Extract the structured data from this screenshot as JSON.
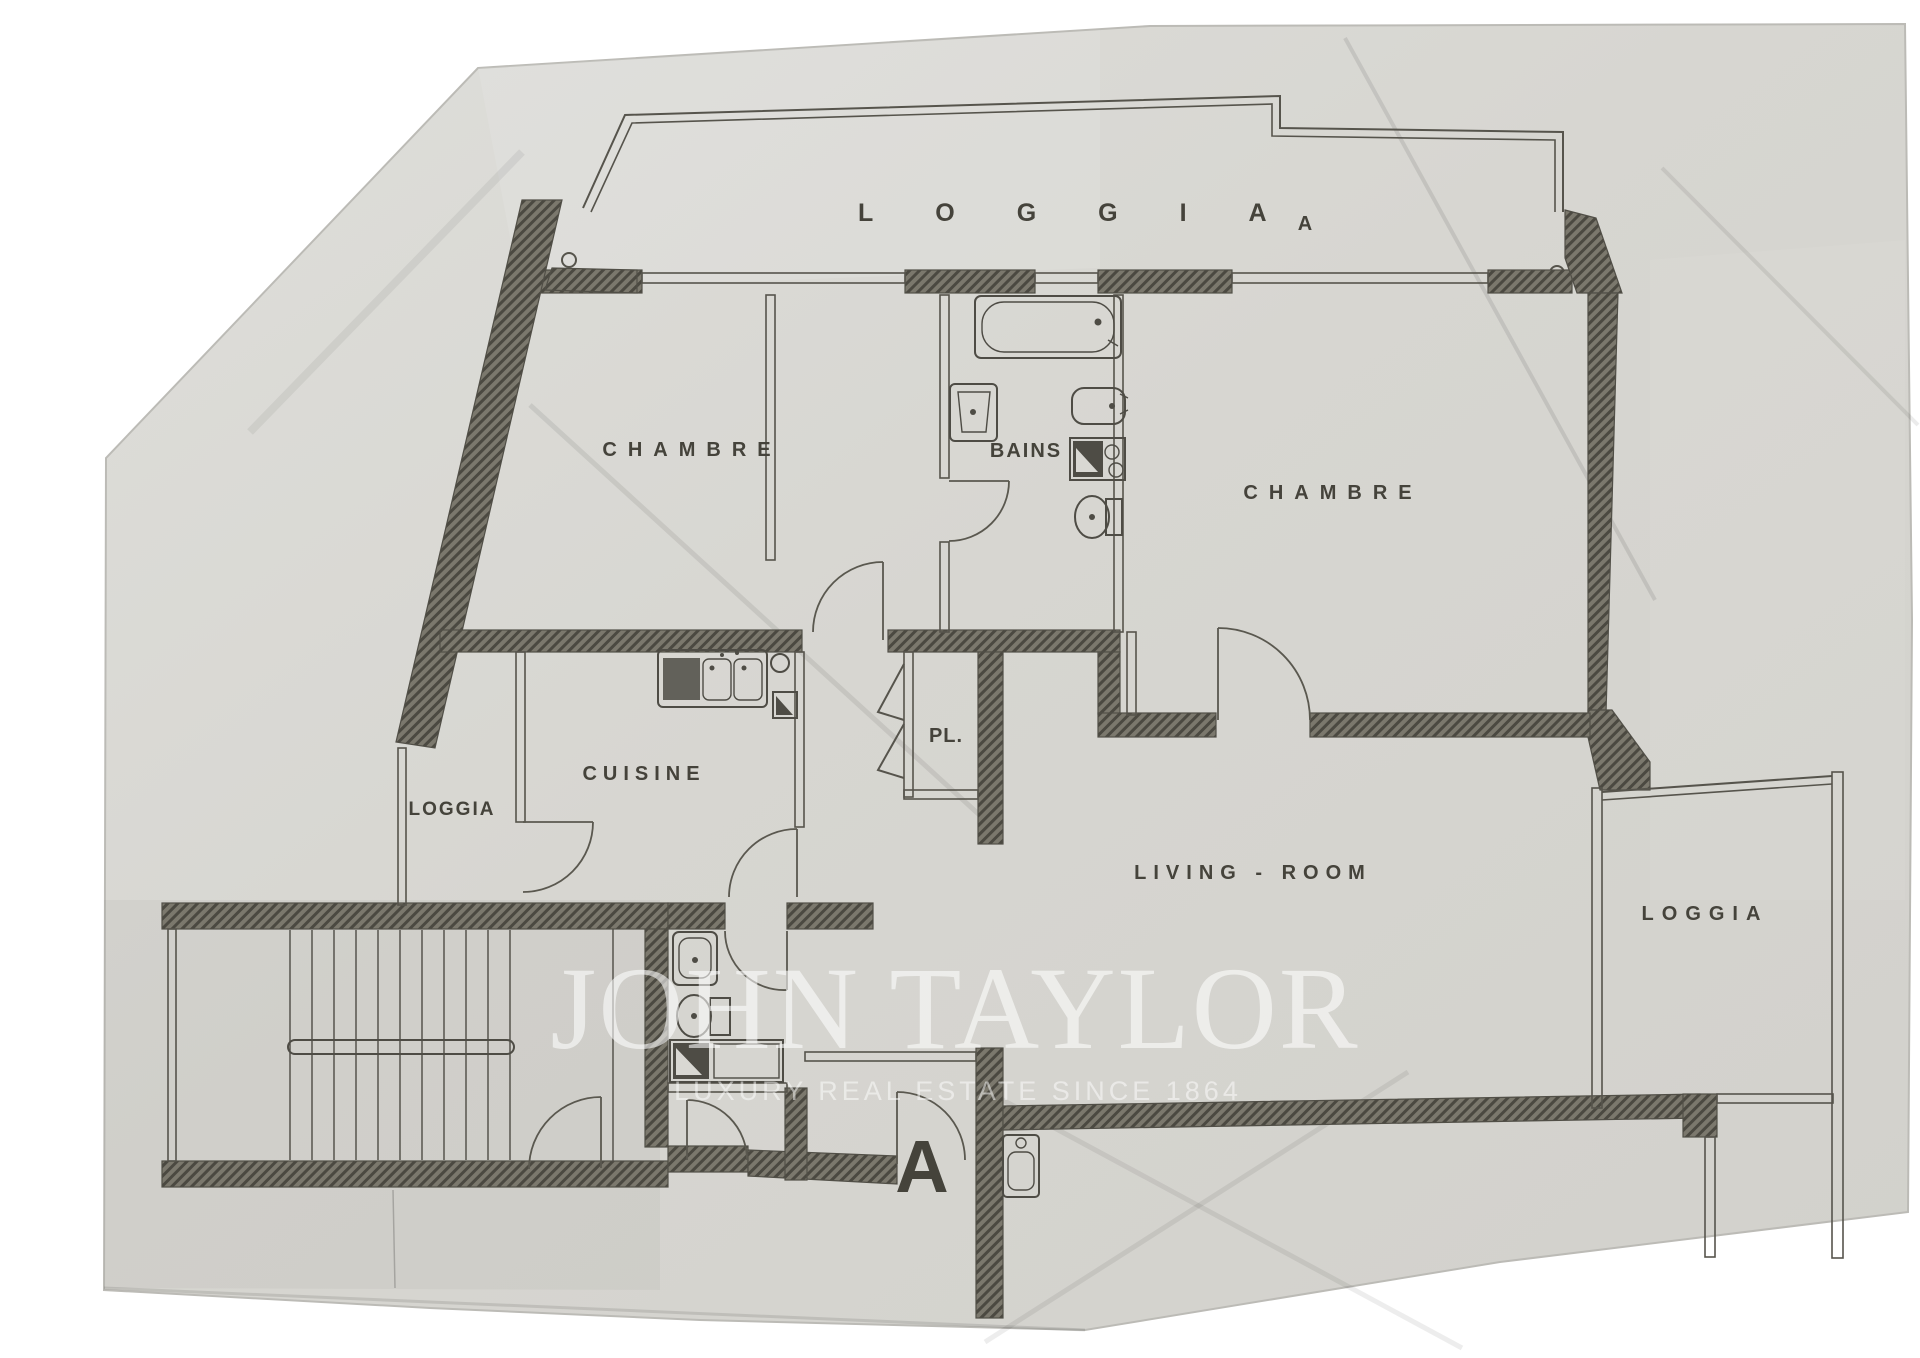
{
  "page": {
    "width_px": 1920,
    "height_px": 1358
  },
  "plan": {
    "rooms": {
      "loggia_top": {
        "label": "LOGGIA"
      },
      "chambre_left": {
        "label": "CHAMBRE"
      },
      "bains": {
        "label": "BAINS"
      },
      "chambre_right": {
        "label": "CHAMBRE"
      },
      "cuisine": {
        "label": "CUISINE"
      },
      "placard": {
        "label": "PL."
      },
      "loggia_left": {
        "label": "LOGGIA"
      },
      "living_room": {
        "label": "LIVING - ROOM"
      },
      "loggia_right": {
        "label": "LOGGIA"
      }
    },
    "markers": {
      "loggia_unit_letter": "A",
      "entrance_letter": "A"
    }
  },
  "watermark": {
    "brand": "JOHN TAYLOR",
    "tagline": "LUXURY REAL ESTATE SINCE 1864"
  },
  "colors": {
    "paper": "#d9d8d3",
    "ink": "#45433b",
    "wall": "#6f6d64",
    "watermark": "#ffffff"
  }
}
